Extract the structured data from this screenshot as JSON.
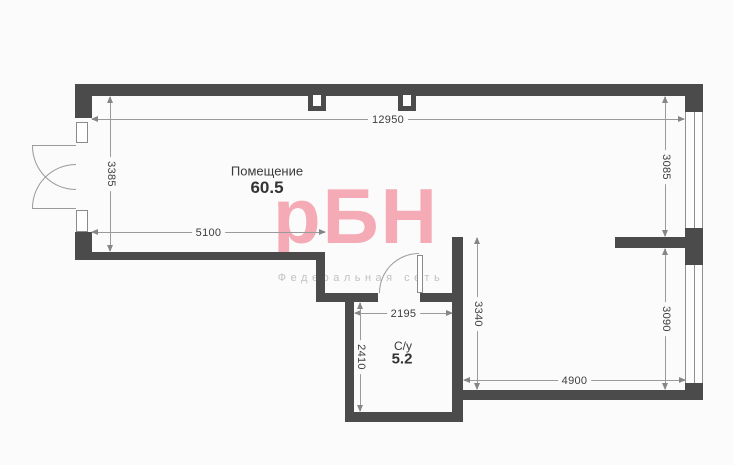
{
  "labels": {
    "room_name": "Помещение",
    "room_area": "60.5",
    "wc_name": "С/у",
    "wc_area": "5.2"
  },
  "dimensions": {
    "top": "12950",
    "left": "3385",
    "right_upper": "3085",
    "bottom_left": "5100",
    "wc_width": "2195",
    "wc_height": "2410",
    "inner_right": "3340",
    "right_lower": "3090",
    "bottom_right": "4900"
  },
  "watermark": {
    "logo": "рБН",
    "tagline": "Федеральная сеть"
  },
  "colors": {
    "wall": "#4b4b4b",
    "dimension_line": "#9a9a9a",
    "dimension_text": "#3d3d3d",
    "watermark_pink": "#f5abb6",
    "watermark_gray": "#c2c2c2",
    "background": "#fbfbfb"
  }
}
